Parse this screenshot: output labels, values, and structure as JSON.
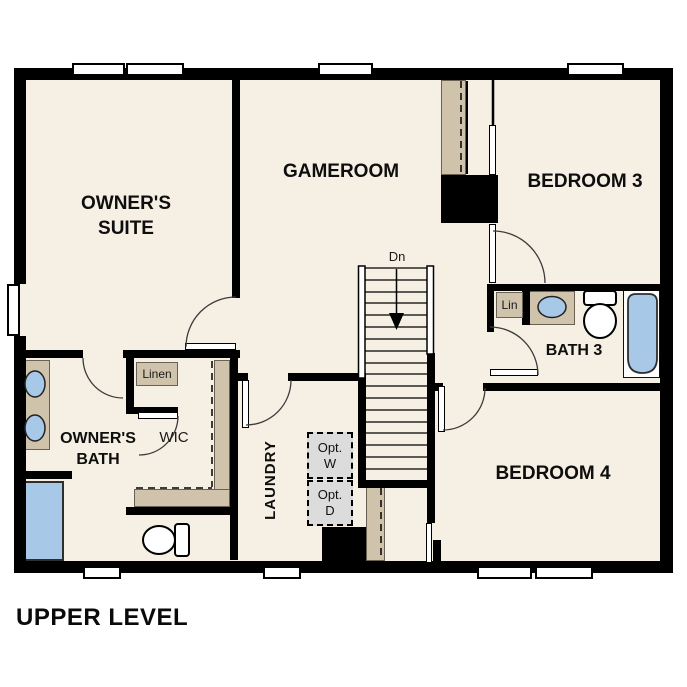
{
  "title": "UPPER LEVEL",
  "rooms": {
    "owners_suite": {
      "line1": "OWNER'S",
      "line2": "SUITE"
    },
    "gameroom": {
      "label": "GAMEROOM"
    },
    "bedroom3": {
      "label": "BEDROOM 3"
    },
    "bedroom4": {
      "label": "BEDROOM 4"
    },
    "owners_bath": {
      "line1": "OWNER'S",
      "line2": "BATH"
    },
    "bath3": {
      "label": "BATH 3"
    },
    "wic": {
      "label": "WIC"
    },
    "laundry": {
      "label": "LAUNDRY"
    }
  },
  "closets": {
    "linen": {
      "label": "Linen"
    },
    "lin": {
      "label": "Lin"
    }
  },
  "stairs": {
    "direction_label": "Dn"
  },
  "options": {
    "washer": {
      "line1": "Opt.",
      "line2": "W"
    },
    "dryer": {
      "line1": "Opt.",
      "line2": "D"
    }
  },
  "colors": {
    "background": "#ffffff",
    "floor": "#f6efe3",
    "wall": "#000000",
    "cabinet_tan": "#cfc3ac",
    "fixture_blue": "#a8c8e8",
    "option_grey": "#dcdcdc"
  }
}
